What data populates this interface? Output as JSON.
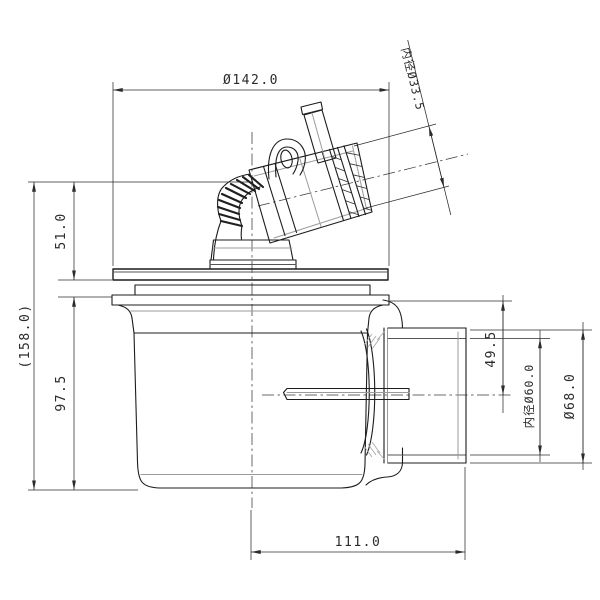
{
  "drawing": {
    "kind": "plumbing-drain-trap-dimension-drawing",
    "background_color": "#ffffff",
    "line_color": "#1c1c1c",
    "dimension_color": "#2b2b2b",
    "dims": {
      "top_width": "Ø142.0",
      "inlet_bore": "内径Ø33.5",
      "upper_height": "51.0",
      "overall_height": "(158.0)",
      "body_height": "97.5",
      "outlet_center_drop": "49.5",
      "outlet_bore": "内径Ø60.0",
      "outlet_od": "Ø68.0",
      "outlet_length": "111.0"
    }
  }
}
